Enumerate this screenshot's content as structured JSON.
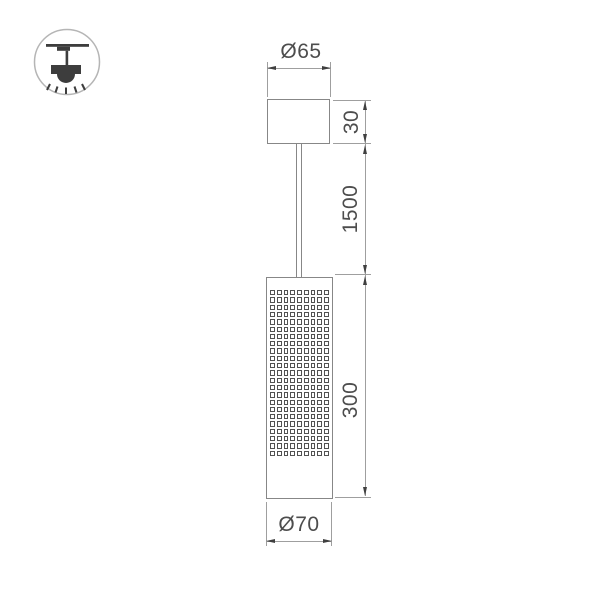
{
  "icon": {
    "name": "pendant-ceiling-mount-icon"
  },
  "dims": {
    "canopy_diameter": "Ø65",
    "canopy_height": "30",
    "cable_length": "1500",
    "body_height": "300",
    "body_diameter": "Ø70"
  },
  "colors": {
    "outline": "#878787",
    "dimline": "#9f9f9f",
    "arrow": "#3f3f3f",
    "text": "#4d4d4d",
    "mesh": "#525252",
    "icon-ink": "#3d3d3d",
    "icon-ring": "#b5b5b5"
  },
  "mesh": {
    "cols": 9,
    "rows": 23
  }
}
